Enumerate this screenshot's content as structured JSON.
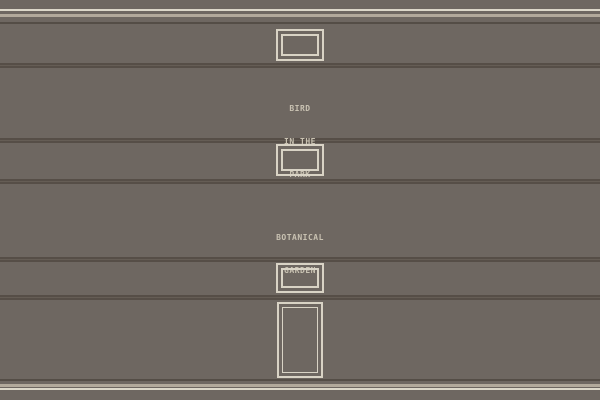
{
  "theme": {
    "wall": "#6e6761",
    "trim_bright": "#dcd7c9",
    "trim_beige": "#b2a99b",
    "trim_dark": "#544d46",
    "groove_dark": "#564e47",
    "groove_mid": "#655d55",
    "frame_light": "#d9d3c5",
    "label_text": "#c9c2b2"
  },
  "labels": [
    {
      "name": "bird-in-the-park",
      "lines": [
        "BIRD",
        "IN THE",
        "PARK"
      ]
    },
    {
      "name": "botanical-garden",
      "lines": [
        "BOTANICAL",
        "GARDEN"
      ]
    }
  ],
  "frames": [
    {
      "name": "small-frame-top"
    },
    {
      "name": "small-frame-middle"
    },
    {
      "name": "small-frame-lower"
    },
    {
      "name": "tall-door-frame"
    }
  ]
}
